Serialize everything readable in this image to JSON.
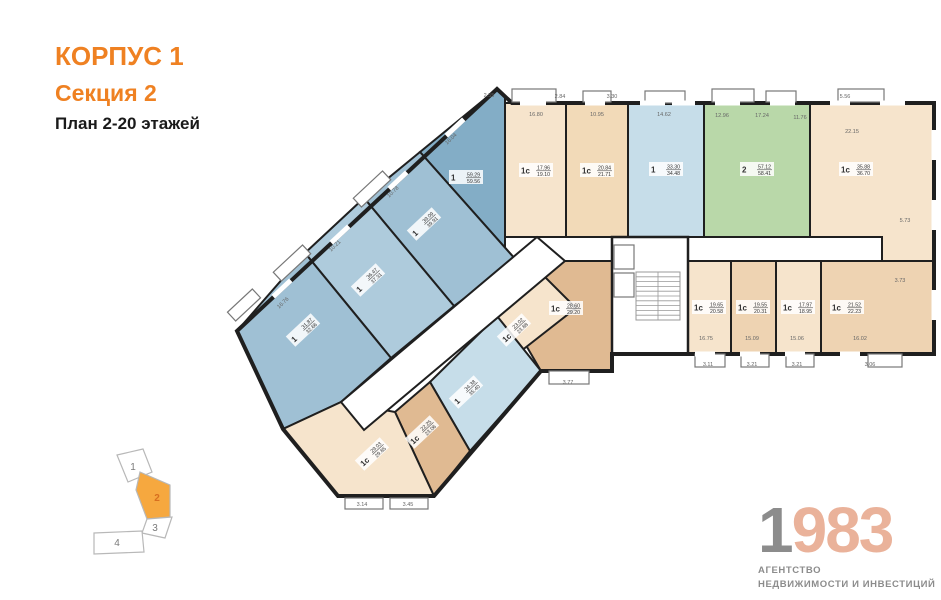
{
  "title": {
    "line1": "КОРПУС 1",
    "line2": "Секция 2",
    "line3": "План 2-20 этажей",
    "accent": "#ef8122",
    "dark": "#1a1a1a"
  },
  "logo": {
    "digit_first": "1",
    "digits_rest": "983",
    "tagline1": "АГЕНТСТВО",
    "tagline2": "НЕДВИЖИМОСТИ И ИНВЕСТИЦИЙ",
    "gray": "#8c8c8c",
    "peach": "#eab29a"
  },
  "colors": {
    "wall": "#1f1f1f",
    "dim_text": "#666666",
    "label_text": "#333333",
    "window": "#ffffff",
    "balcony_stroke": "#777777"
  },
  "plan": {
    "outline": "497,89 512,103 934,103 934,354 688,354 688,354 612,354 612,371 541,371 434,496 338,496 283,429 237,331",
    "apartments": [
      {
        "id": "1-59",
        "type": "1",
        "a1": "59.29",
        "a2": "59.56",
        "fill": "#83adc6",
        "points": "420,152 497,89 505,97 505,250 516,260",
        "label": {
          "x": 466,
          "y": 177,
          "rot": 0
        }
      },
      {
        "id": "1-39",
        "type": "1",
        "a1": "39.09",
        "a2": "39.91",
        "fill": "#9fc0d4",
        "points": "364,198 420,152 516,260 454,306",
        "label": {
          "x": 424,
          "y": 224,
          "rot": -43
        }
      },
      {
        "id": "1-36",
        "type": "1",
        "a1": "36.47",
        "a2": "37.31",
        "fill": "#aecbdc",
        "points": "305,253 364,198 454,306 391,358",
        "label": {
          "x": 368,
          "y": 280,
          "rot": -43
        }
      },
      {
        "id": "1-31",
        "type": "1",
        "a1": "31.87",
        "a2": "32.66",
        "fill": "#9fc0d4",
        "points": "237,331 305,253 391,358 341,402 283,429",
        "label": {
          "x": 303,
          "y": 330,
          "rot": -43
        }
      },
      {
        "id": "1c-1796",
        "type": "1с",
        "a1": "17.96",
        "a2": "19.10",
        "fill": "#f6e4cc",
        "points": "505,103 566,103 566,237 505,237",
        "label": {
          "x": 536,
          "y": 170,
          "rot": 0
        }
      },
      {
        "id": "1c-2084",
        "type": "1с",
        "a1": "20.84",
        "a2": "21.71",
        "fill": "#f2dab8",
        "points": "566,103 628,103 628,237 566,237",
        "label": {
          "x": 597,
          "y": 170,
          "rot": 0
        }
      },
      {
        "id": "1-3330",
        "type": "1",
        "a1": "33.30",
        "a2": "34.48",
        "fill": "#c6dde9",
        "points": "628,103 704,103 704,237 628,237",
        "label": {
          "x": 666,
          "y": 169,
          "rot": 0
        }
      },
      {
        "id": "2-5712",
        "type": "2",
        "a1": "57.12",
        "a2": "58.41",
        "fill": "#b9d8a9",
        "points": "704,103 810,103 810,237 704,237",
        "label": {
          "x": 757,
          "y": 169,
          "rot": 0
        }
      },
      {
        "id": "1c-3588",
        "type": "1с",
        "a1": "35.88",
        "a2": "36.70",
        "fill": "#f6e4cc",
        "points": "810,103 934,103 934,262 882,262 882,237 810,237",
        "label": {
          "x": 856,
          "y": 169,
          "rot": 0
        }
      },
      {
        "id": "1c-1965",
        "type": "1с",
        "a1": "19.65",
        "a2": "20.58",
        "fill": "#f6e4cc",
        "points": "688,261 731,261 731,354 688,354",
        "label": {
          "x": 709,
          "y": 307,
          "rot": 0
        }
      },
      {
        "id": "1c-1955",
        "type": "1с",
        "a1": "19.55",
        "a2": "20.31",
        "fill": "#eed3b2",
        "points": "731,261 776,261 776,354 731,354",
        "label": {
          "x": 753,
          "y": 307,
          "rot": 0
        }
      },
      {
        "id": "1c-1797",
        "type": "1с",
        "a1": "17.97",
        "a2": "18.95",
        "fill": "#f6e4cc",
        "points": "776,261 821,261 821,354 776,354",
        "label": {
          "x": 798,
          "y": 307,
          "rot": 0
        }
      },
      {
        "id": "1c-2152",
        "type": "1с",
        "a1": "21.52",
        "a2": "22.23",
        "fill": "#eed3b2",
        "points": "821,261 934,261 934,354 821,354",
        "label": {
          "x": 847,
          "y": 307,
          "rot": 0
        }
      },
      {
        "id": "1c-2860",
        "type": "1с",
        "a1": "28.60",
        "a2": "29.20",
        "fill": "#e0ba92",
        "points": "552,261 612,261 612,371 541,371 506,311",
        "label": {
          "x": 566,
          "y": 308,
          "rot": 0
        }
      },
      {
        "id": "1c-2302",
        "type": "1с",
        "a1": "23.02",
        "a2": "23.88",
        "fill": "#f6e4cc",
        "points": "497,316 540,272 576,308 516,355",
        "label": {
          "x": 514,
          "y": 330,
          "rot": -43
        }
      },
      {
        "id": "1-3438",
        "type": "1",
        "a1": "34.38",
        "a2": "35.40",
        "fill": "#c6dde9",
        "points": "430,382 497,316 541,371 470,451",
        "label": {
          "x": 466,
          "y": 392,
          "rot": -43
        }
      },
      {
        "id": "1c-2225",
        "type": "1с",
        "a1": "22.25",
        "a2": "23.06",
        "fill": "#e0ba92",
        "points": "395,412 430,382 470,451 434,496",
        "label": {
          "x": 422,
          "y": 432,
          "rot": -43
        }
      },
      {
        "id": "1c-2903",
        "type": "1с",
        "a1": "29.03",
        "a2": "29.85",
        "fill": "#f6e4cc",
        "points": "341,402 395,412 434,496 338,496 283,429",
        "label": {
          "x": 372,
          "y": 454,
          "rot": -43
        }
      }
    ],
    "corridors": [
      {
        "id": "corridor-main",
        "points": "537,237 882,237 882,261 537,261"
      },
      {
        "id": "corridor-wing",
        "points": "537,237 565,261 364,430 341,402"
      }
    ],
    "core": {
      "x": 612,
      "y": 237,
      "w": 76,
      "h": 117,
      "stairs": {
        "x": 636,
        "y": 272,
        "w": 44,
        "h": 48,
        "steps": 10
      },
      "elevators": [
        {
          "x": 614,
          "y": 245,
          "w": 20,
          "h": 24
        },
        {
          "x": 614,
          "y": 273,
          "w": 20,
          "h": 24
        }
      ]
    },
    "balconies": [
      {
        "x": 512,
        "y": 89,
        "w": 44,
        "h": 13,
        "rot": 0
      },
      {
        "x": 583,
        "y": 91,
        "w": 28,
        "h": 11,
        "rot": 0
      },
      {
        "x": 645,
        "y": 91,
        "w": 40,
        "h": 12,
        "rot": 0
      },
      {
        "x": 712,
        "y": 89,
        "w": 42,
        "h": 13,
        "rot": 0
      },
      {
        "x": 766,
        "y": 91,
        "w": 30,
        "h": 11,
        "rot": 0
      },
      {
        "x": 838,
        "y": 89,
        "w": 46,
        "h": 13,
        "rot": 0
      },
      {
        "x": 695,
        "y": 354,
        "w": 30,
        "h": 13,
        "rot": 0
      },
      {
        "x": 741,
        "y": 354,
        "w": 28,
        "h": 13,
        "rot": 0
      },
      {
        "x": 786,
        "y": 354,
        "w": 28,
        "h": 13,
        "rot": 0
      },
      {
        "x": 868,
        "y": 354,
        "w": 34,
        "h": 13,
        "rot": 0
      },
      {
        "x": 549,
        "y": 371,
        "w": 40,
        "h": 13,
        "rot": 0
      },
      {
        "x": 352,
        "y": 183,
        "w": 40,
        "h": 12,
        "rot": -43
      },
      {
        "x": 272,
        "y": 257,
        "w": 40,
        "h": 12,
        "rot": -43
      },
      {
        "x": 227,
        "y": 299,
        "w": 34,
        "h": 12,
        "rot": -43
      },
      {
        "x": 345,
        "y": 498,
        "w": 38,
        "h": 11,
        "rot": 0
      },
      {
        "x": 390,
        "y": 498,
        "w": 38,
        "h": 11,
        "rot": 0
      }
    ],
    "windows": [
      {
        "x": 520,
        "y": 100.5,
        "w": 26,
        "h": 5,
        "rot": 0
      },
      {
        "x": 585,
        "y": 100.5,
        "w": 20,
        "h": 5,
        "rot": 0
      },
      {
        "x": 640,
        "y": 100.5,
        "w": 25,
        "h": 5,
        "rot": 0
      },
      {
        "x": 672,
        "y": 100.5,
        "w": 23,
        "h": 5,
        "rot": 0
      },
      {
        "x": 715,
        "y": 100.5,
        "w": 25,
        "h": 5,
        "rot": 0
      },
      {
        "x": 770,
        "y": 100.5,
        "w": 25,
        "h": 5,
        "rot": 0
      },
      {
        "x": 830,
        "y": 100.5,
        "w": 20,
        "h": 5,
        "rot": 0
      },
      {
        "x": 880,
        "y": 100.5,
        "w": 25,
        "h": 5,
        "rot": 0
      },
      {
        "x": 695,
        "y": 351.5,
        "w": 20,
        "h": 5,
        "rot": 0
      },
      {
        "x": 740,
        "y": 351.5,
        "w": 20,
        "h": 5,
        "rot": 0
      },
      {
        "x": 785,
        "y": 351.5,
        "w": 20,
        "h": 5,
        "rot": 0
      },
      {
        "x": 840,
        "y": 351.5,
        "w": 20,
        "h": 5,
        "rot": 0
      },
      {
        "x": 931.5,
        "y": 130,
        "w": 5,
        "h": 30,
        "rot": 0
      },
      {
        "x": 931.5,
        "y": 200,
        "w": 5,
        "h": 30,
        "rot": 0
      },
      {
        "x": 931.5,
        "y": 290,
        "w": 5,
        "h": 30,
        "rot": 0
      },
      {
        "x": 443,
        "y": 125,
        "w": 24,
        "h": 5,
        "rot": -43
      },
      {
        "x": 386,
        "y": 178,
        "w": 24,
        "h": 5,
        "rot": -43
      },
      {
        "x": 328,
        "y": 232,
        "w": 24,
        "h": 5,
        "rot": -43
      },
      {
        "x": 270,
        "y": 286,
        "w": 24,
        "h": 5,
        "rot": -43
      }
    ],
    "dimensions": [
      {
        "t": "2.55",
        "x": 489,
        "y": 97,
        "rot": 0
      },
      {
        "t": "2.84",
        "x": 560,
        "y": 98,
        "rot": 0
      },
      {
        "t": "3.30",
        "x": 612,
        "y": 98,
        "rot": 0
      },
      {
        "t": "16.80",
        "x": 536,
        "y": 116,
        "rot": 0
      },
      {
        "t": "10.95",
        "x": 597,
        "y": 116,
        "rot": 0
      },
      {
        "t": "14.62",
        "x": 664,
        "y": 116,
        "rot": 0
      },
      {
        "t": "12.96",
        "x": 722,
        "y": 117,
        "rot": 0
      },
      {
        "t": "17.24",
        "x": 762,
        "y": 117,
        "rot": 0
      },
      {
        "t": "11.76",
        "x": 800,
        "y": 119,
        "rot": 0
      },
      {
        "t": "5.56",
        "x": 845,
        "y": 98,
        "rot": 0
      },
      {
        "t": "22.15",
        "x": 852,
        "y": 133,
        "rot": 0
      },
      {
        "t": "16.04",
        "x": 452,
        "y": 140,
        "rot": -43
      },
      {
        "t": "10.78",
        "x": 394,
        "y": 193,
        "rot": -43
      },
      {
        "t": "10.21",
        "x": 336,
        "y": 247,
        "rot": -43
      },
      {
        "t": "16.76",
        "x": 284,
        "y": 304,
        "rot": -43
      },
      {
        "t": "5.73",
        "x": 905,
        "y": 222,
        "rot": 0
      },
      {
        "t": "3.73",
        "x": 900,
        "y": 282,
        "rot": 0
      },
      {
        "t": "16.75",
        "x": 706,
        "y": 340,
        "rot": 0
      },
      {
        "t": "15.09",
        "x": 752,
        "y": 340,
        "rot": 0
      },
      {
        "t": "15.06",
        "x": 797,
        "y": 340,
        "rot": 0
      },
      {
        "t": "16.02",
        "x": 860,
        "y": 340,
        "rot": 0
      },
      {
        "t": "3.11",
        "x": 708,
        "y": 366,
        "rot": 0
      },
      {
        "t": "3.21",
        "x": 752,
        "y": 366,
        "rot": 0
      },
      {
        "t": "3.21",
        "x": 797,
        "y": 366,
        "rot": 0
      },
      {
        "t": "3.06",
        "x": 870,
        "y": 366,
        "rot": 0
      },
      {
        "t": "3.77",
        "x": 568,
        "y": 384,
        "rot": 0
      },
      {
        "t": "3.14",
        "x": 362,
        "y": 506,
        "rot": 0
      },
      {
        "t": "3.45",
        "x": 408,
        "y": 506,
        "rot": 0
      }
    ]
  },
  "minimap": {
    "stroke": "#b8b8b8",
    "num_color": "#7a7a7a",
    "active_fill": "#f6a83f",
    "active_num_color": "#d86f1f",
    "sections": [
      {
        "num": "1",
        "points": "117,455 143,449 152,472 128,482",
        "active": false,
        "lx": 133,
        "ly": 470
      },
      {
        "num": "2",
        "points": "140,472 170,485 170,517 147,519 136,490",
        "active": true,
        "lx": 157,
        "ly": 501
      },
      {
        "num": "3",
        "points": "147,519 172,517 165,538 142,533",
        "active": false,
        "lx": 155,
        "ly": 531
      },
      {
        "num": "4",
        "points": "94,533 142,531 144,552 94,554",
        "active": false,
        "lx": 117,
        "ly": 546
      }
    ]
  }
}
